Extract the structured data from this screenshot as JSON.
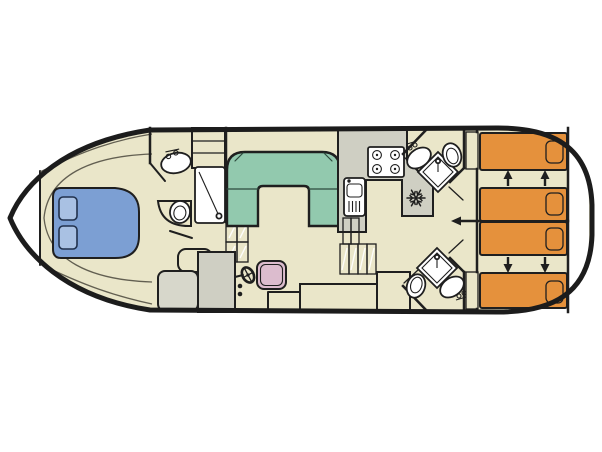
{
  "diagram": {
    "type": "boat-deck-floor-plan",
    "areas": [
      "bow-double-berth",
      "forward-bathroom",
      "saloon-u-sofa",
      "galley",
      "helm-station",
      "aft-bathroom-top",
      "aft-bathroom-bottom",
      "aft-twin-cabin-top",
      "aft-twin-cabin-bottom"
    ],
    "icons": [
      "stove-icon",
      "sink-icon",
      "fridge-snowflake-icon",
      "shower-icon",
      "toilet-icon",
      "washbasin-icon",
      "steering-wheel-icon",
      "steps-icon",
      "bed-slide-arrow-icon",
      "door-icon"
    ]
  },
  "colors": {
    "outline": "#1f1f1f",
    "exterior": "#ffffff",
    "interior": "#eae6c9",
    "sofa": "#92c9ae",
    "bow_bed": "#7c9fd3",
    "bow_pillow": "#a9c1e3",
    "cabin_bed": "#e5913c",
    "cabin_pillow": "#efac63",
    "counter": "#cfcfc3",
    "seat_gray": "#d7d7cb",
    "door_panel": "#c6c6ba",
    "helm_seat": "#dcbcce",
    "steps": "#e0ddcd",
    "fixture_white": "#ffffff"
  }
}
